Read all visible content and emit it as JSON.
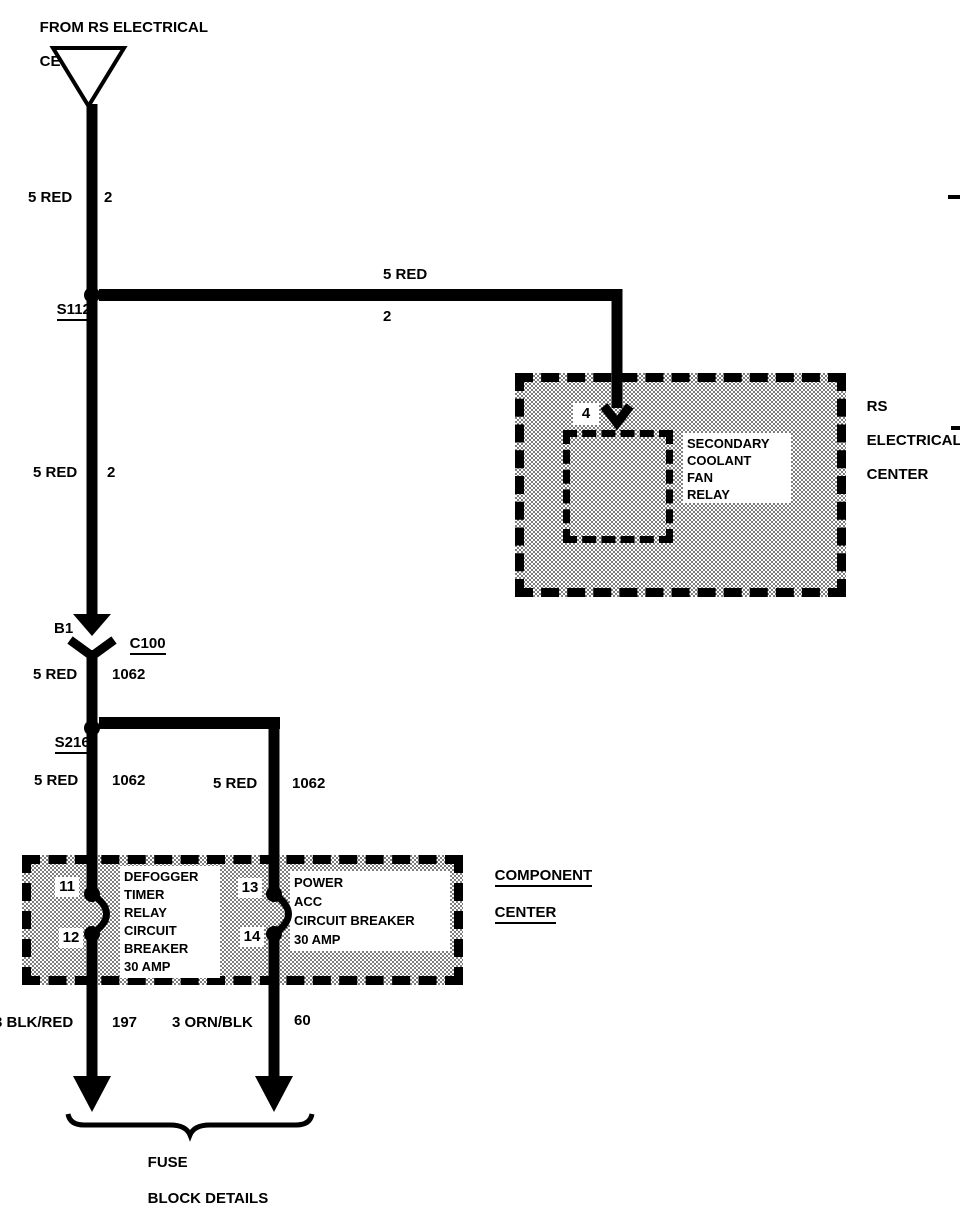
{
  "header": {
    "from_line1": "FROM RS ELECTRICAL",
    "from_line2": "CENTER",
    "connector_letter": "C"
  },
  "splices": {
    "s112": "S112",
    "s216": "S216"
  },
  "connector_c100": {
    "pin": "B1",
    "id": "C100"
  },
  "wire_labels": {
    "seg1": {
      "color": "5 RED",
      "circuit": "2"
    },
    "branch": {
      "color": "5 RED",
      "circuit": "2"
    },
    "seg2": {
      "color": "5 RED",
      "circuit": "2"
    },
    "seg3": {
      "color": "5 RED",
      "circuit": "1062"
    },
    "seg4_left": {
      "color": "5 RED",
      "circuit": "1062"
    },
    "seg4_right": {
      "color": "5 RED",
      "circuit": "1062"
    },
    "out_left": {
      "color": "3 BLK/RED",
      "circuit": "197"
    },
    "out_right": {
      "color": "3 ORN/BLK",
      "circuit": "60"
    }
  },
  "rs_center": {
    "label_line1": "RS",
    "label_line2": "ELECTRICAL",
    "label_line3": "CENTER",
    "terminal": "4",
    "device_line1": "SECONDARY",
    "device_line2": "COOLANT",
    "device_line3": "FAN",
    "device_line4": "RELAY"
  },
  "component_center": {
    "label_line1": "COMPONENT",
    "label_line2": "CENTER",
    "terminal_11": "11",
    "terminal_12": "12",
    "terminal_13": "13",
    "terminal_14": "14",
    "left_device_line1": "DEFOGGER",
    "left_device_line2": "TIMER",
    "left_device_line3": "RELAY",
    "left_device_line4": "CIRCUIT",
    "left_device_line5": "BREAKER",
    "left_device_line6": "30 AMP",
    "right_device_line1": "POWER",
    "right_device_line2": "ACC",
    "right_device_line3": "CIRCUIT BREAKER",
    "right_device_line4": "30 AMP"
  },
  "footer": {
    "brace_label_line1": "FUSE",
    "brace_label_line2": "BLOCK DETAILS"
  },
  "colors": {
    "ink": "#000000",
    "paper": "#ffffff"
  }
}
